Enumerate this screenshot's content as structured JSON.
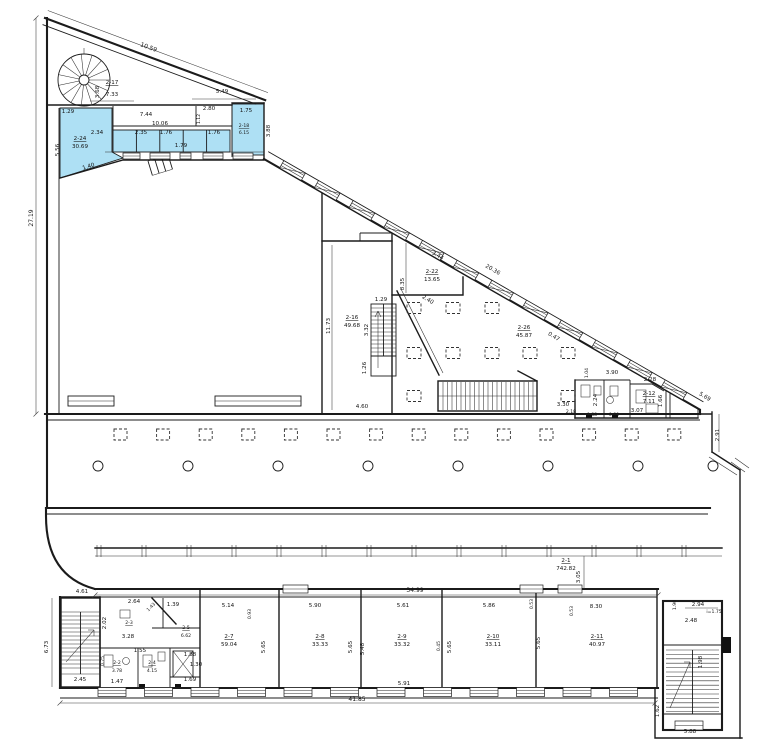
{
  "meta": {
    "type": "architectural-floor-plan",
    "units": "meters"
  },
  "colors": {
    "highlight": "#aee0f4",
    "wall": "#1b1b1b",
    "background": "#ffffff"
  },
  "labels": [
    {
      "t": "10.59",
      "x": 148,
      "y": 49,
      "r": 20,
      "s": 6
    },
    {
      "t": "3.68",
      "x": 99,
      "y": 92,
      "r": -90
    },
    {
      "t": "2-17",
      "x": 112,
      "y": 84,
      "u": 1
    },
    {
      "t": "7.33",
      "x": 112,
      "y": 96
    },
    {
      "t": "5.49",
      "x": 222,
      "y": 93
    },
    {
      "t": "1.29",
      "x": 68,
      "y": 113
    },
    {
      "t": "7.44",
      "x": 146,
      "y": 116
    },
    {
      "t": "10.06",
      "x": 160,
      "y": 125
    },
    {
      "t": "2.80",
      "x": 209,
      "y": 110
    },
    {
      "t": "1.12",
      "x": 200,
      "y": 119,
      "r": -90,
      "s": 4.6
    },
    {
      "t": "1.75",
      "x": 246,
      "y": 112
    },
    {
      "t": "3.88",
      "x": 270,
      "y": 131,
      "r": -90
    },
    {
      "t": "2.34",
      "x": 97,
      "y": 134
    },
    {
      "t": "2.35",
      "x": 141,
      "y": 134
    },
    {
      "t": "1.76",
      "x": 166,
      "y": 134
    },
    {
      "t": "1.79",
      "x": 181,
      "y": 147
    },
    {
      "t": "1.76",
      "x": 214,
      "y": 134
    },
    {
      "t": "2-18",
      "x": 244,
      "y": 127,
      "u": 1,
      "s": 4.6
    },
    {
      "t": "6.15",
      "x": 244,
      "y": 134,
      "s": 4.6
    },
    {
      "t": "2-24",
      "x": 80,
      "y": 140,
      "u": 1
    },
    {
      "t": "30.69",
      "x": 80,
      "y": 148
    },
    {
      "t": "5.56",
      "x": 59,
      "y": 150,
      "r": -90
    },
    {
      "t": "1.40",
      "x": 89,
      "y": 168,
      "r": -17
    },
    {
      "t": "27.19",
      "x": 33,
      "y": 218,
      "r": -90,
      "s": 6
    },
    {
      "t": "11.73",
      "x": 330,
      "y": 326,
      "r": -90
    },
    {
      "t": "2-16",
      "x": 352,
      "y": 319,
      "u": 1
    },
    {
      "t": "49.68",
      "x": 352,
      "y": 327
    },
    {
      "t": "1.29",
      "x": 381,
      "y": 301
    },
    {
      "t": "3.32",
      "x": 368,
      "y": 330,
      "r": -90
    },
    {
      "t": "1.26",
      "x": 366,
      "y": 368,
      "r": -90
    },
    {
      "t": "4.60",
      "x": 362,
      "y": 408
    },
    {
      "t": "2-22",
      "x": 432,
      "y": 273,
      "u": 1
    },
    {
      "t": "13.65",
      "x": 432,
      "y": 281
    },
    {
      "t": "8.35",
      "x": 404,
      "y": 284,
      "r": -90
    },
    {
      "t": "3.44",
      "x": 437,
      "y": 257,
      "r": 30
    },
    {
      "t": "20.36",
      "x": 492,
      "y": 271,
      "r": 30
    },
    {
      "t": "2.40",
      "x": 427,
      "y": 301,
      "r": 32
    },
    {
      "t": "2-26",
      "x": 524,
      "y": 329,
      "u": 1
    },
    {
      "t": "45.87",
      "x": 524,
      "y": 337
    },
    {
      "t": "0.47",
      "x": 553,
      "y": 338,
      "r": 31
    },
    {
      "t": "3.30",
      "x": 563,
      "y": 406
    },
    {
      "t": "2.18",
      "x": 571,
      "y": 413,
      "s": 4.6
    },
    {
      "t": "3.90",
      "x": 612,
      "y": 374
    },
    {
      "t": "1.04",
      "x": 588,
      "y": 373,
      "r": -90,
      "s": 4.6
    },
    {
      "t": "2.28",
      "x": 650,
      "y": 381
    },
    {
      "t": "2.24",
      "x": 597,
      "y": 400,
      "r": -90
    },
    {
      "t": "2-12",
      "x": 649,
      "y": 395,
      "u": 1
    },
    {
      "t": "7.11",
      "x": 649,
      "y": 403
    },
    {
      "t": "3.07",
      "x": 637,
      "y": 412
    },
    {
      "t": "0.88",
      "x": 592,
      "y": 416,
      "s": 4.6
    },
    {
      "t": "0.80",
      "x": 614,
      "y": 416,
      "s": 4.6
    },
    {
      "t": "1.66",
      "x": 662,
      "y": 401,
      "r": -90
    },
    {
      "t": "5.69",
      "x": 704,
      "y": 398,
      "r": 31
    },
    {
      "t": "2.91",
      "x": 719,
      "y": 435,
      "r": -90
    },
    {
      "t": "2-1",
      "x": 566,
      "y": 562,
      "u": 1
    },
    {
      "t": "742.82",
      "x": 566,
      "y": 570
    },
    {
      "t": "3.05",
      "x": 580,
      "y": 577,
      "r": -90
    },
    {
      "t": "34.99",
      "x": 415,
      "y": 592,
      "s": 6
    },
    {
      "t": "4.61",
      "x": 82,
      "y": 593
    },
    {
      "t": "6.73",
      "x": 48,
      "y": 647,
      "r": -90
    },
    {
      "t": "2.45",
      "x": 80,
      "y": 681
    },
    {
      "t": "2.64",
      "x": 134,
      "y": 603
    },
    {
      "t": "1.43",
      "x": 152,
      "y": 608,
      "r": -45,
      "s": 4.6
    },
    {
      "t": "1.39",
      "x": 173,
      "y": 606
    },
    {
      "t": "2.02",
      "x": 106,
      "y": 623,
      "r": -90
    },
    {
      "t": "2-3",
      "x": 129,
      "y": 624,
      "u": 1,
      "s": 4.6
    },
    {
      "t": "3.28",
      "x": 128,
      "y": 638
    },
    {
      "t": "2-5",
      "x": 186,
      "y": 629,
      "u": 1,
      "s": 4.6
    },
    {
      "t": "6.62",
      "x": 186,
      "y": 637,
      "s": 4.6
    },
    {
      "t": "1.55",
      "x": 140,
      "y": 652
    },
    {
      "t": "0.75",
      "x": 104,
      "y": 661,
      "r": -90,
      "s": 4.6
    },
    {
      "t": "2-2",
      "x": 117,
      "y": 664,
      "u": 1,
      "s": 4.6
    },
    {
      "t": "3.78",
      "x": 117,
      "y": 672,
      "s": 4.6
    },
    {
      "t": "2-4",
      "x": 152,
      "y": 664,
      "u": 1,
      "s": 4.6
    },
    {
      "t": "4.15",
      "x": 152,
      "y": 672,
      "s": 4.6
    },
    {
      "t": "1.47",
      "x": 117,
      "y": 683
    },
    {
      "t": "1.88",
      "x": 190,
      "y": 656
    },
    {
      "t": "1.30",
      "x": 196,
      "y": 666
    },
    {
      "t": "1.69",
      "x": 190,
      "y": 681
    },
    {
      "t": "5.14",
      "x": 228,
      "y": 607
    },
    {
      "t": "0.93",
      "x": 251,
      "y": 614,
      "r": -90,
      "s": 4.6
    },
    {
      "t": "2-7",
      "x": 229,
      "y": 638,
      "u": 1
    },
    {
      "t": "59.04",
      "x": 229,
      "y": 646
    },
    {
      "t": "5.65",
      "x": 265,
      "y": 647,
      "r": -90
    },
    {
      "t": "5.90",
      "x": 315,
      "y": 607
    },
    {
      "t": "2-8",
      "x": 320,
      "y": 638,
      "u": 1
    },
    {
      "t": "33.33",
      "x": 320,
      "y": 646
    },
    {
      "t": "5.65",
      "x": 352,
      "y": 647,
      "r": -90
    },
    {
      "t": "5.48",
      "x": 364,
      "y": 649,
      "r": -90
    },
    {
      "t": "5.61",
      "x": 403,
      "y": 607
    },
    {
      "t": "2-9",
      "x": 402,
      "y": 638,
      "u": 1
    },
    {
      "t": "33.32",
      "x": 402,
      "y": 646
    },
    {
      "t": "0.45",
      "x": 440,
      "y": 646,
      "r": -90,
      "s": 4.6
    },
    {
      "t": "5.65",
      "x": 451,
      "y": 647,
      "r": -90
    },
    {
      "t": "5.91",
      "x": 404,
      "y": 685
    },
    {
      "t": "5.86",
      "x": 489,
      "y": 607
    },
    {
      "t": "2-10",
      "x": 493,
      "y": 638,
      "u": 1
    },
    {
      "t": "33.11",
      "x": 493,
      "y": 646
    },
    {
      "t": "0.53",
      "x": 533,
      "y": 604,
      "r": -90,
      "s": 4.6
    },
    {
      "t": "0.53",
      "x": 573,
      "y": 611,
      "r": -90,
      "s": 4.6
    },
    {
      "t": "8.30",
      "x": 596,
      "y": 608
    },
    {
      "t": "2-11",
      "x": 597,
      "y": 638,
      "u": 1
    },
    {
      "t": "40.97",
      "x": 597,
      "y": 646
    },
    {
      "t": "5.65",
      "x": 540,
      "y": 643,
      "r": -90
    },
    {
      "t": "41.85",
      "x": 357,
      "y": 701,
      "s": 6
    },
    {
      "t": "2.94",
      "x": 698,
      "y": 606
    },
    {
      "t": "i=1.75",
      "x": 714,
      "y": 613,
      "s": 4.6
    },
    {
      "t": "2.48",
      "x": 691,
      "y": 622
    },
    {
      "t": "1.90",
      "x": 676,
      "y": 605,
      "r": -90,
      "s": 4.6
    },
    {
      "t": "1.98",
      "x": 702,
      "y": 662,
      "r": -90
    },
    {
      "t": "1.62",
      "x": 659,
      "y": 711,
      "r": -90
    },
    {
      "t": "5.88",
      "x": 690,
      "y": 733
    }
  ]
}
